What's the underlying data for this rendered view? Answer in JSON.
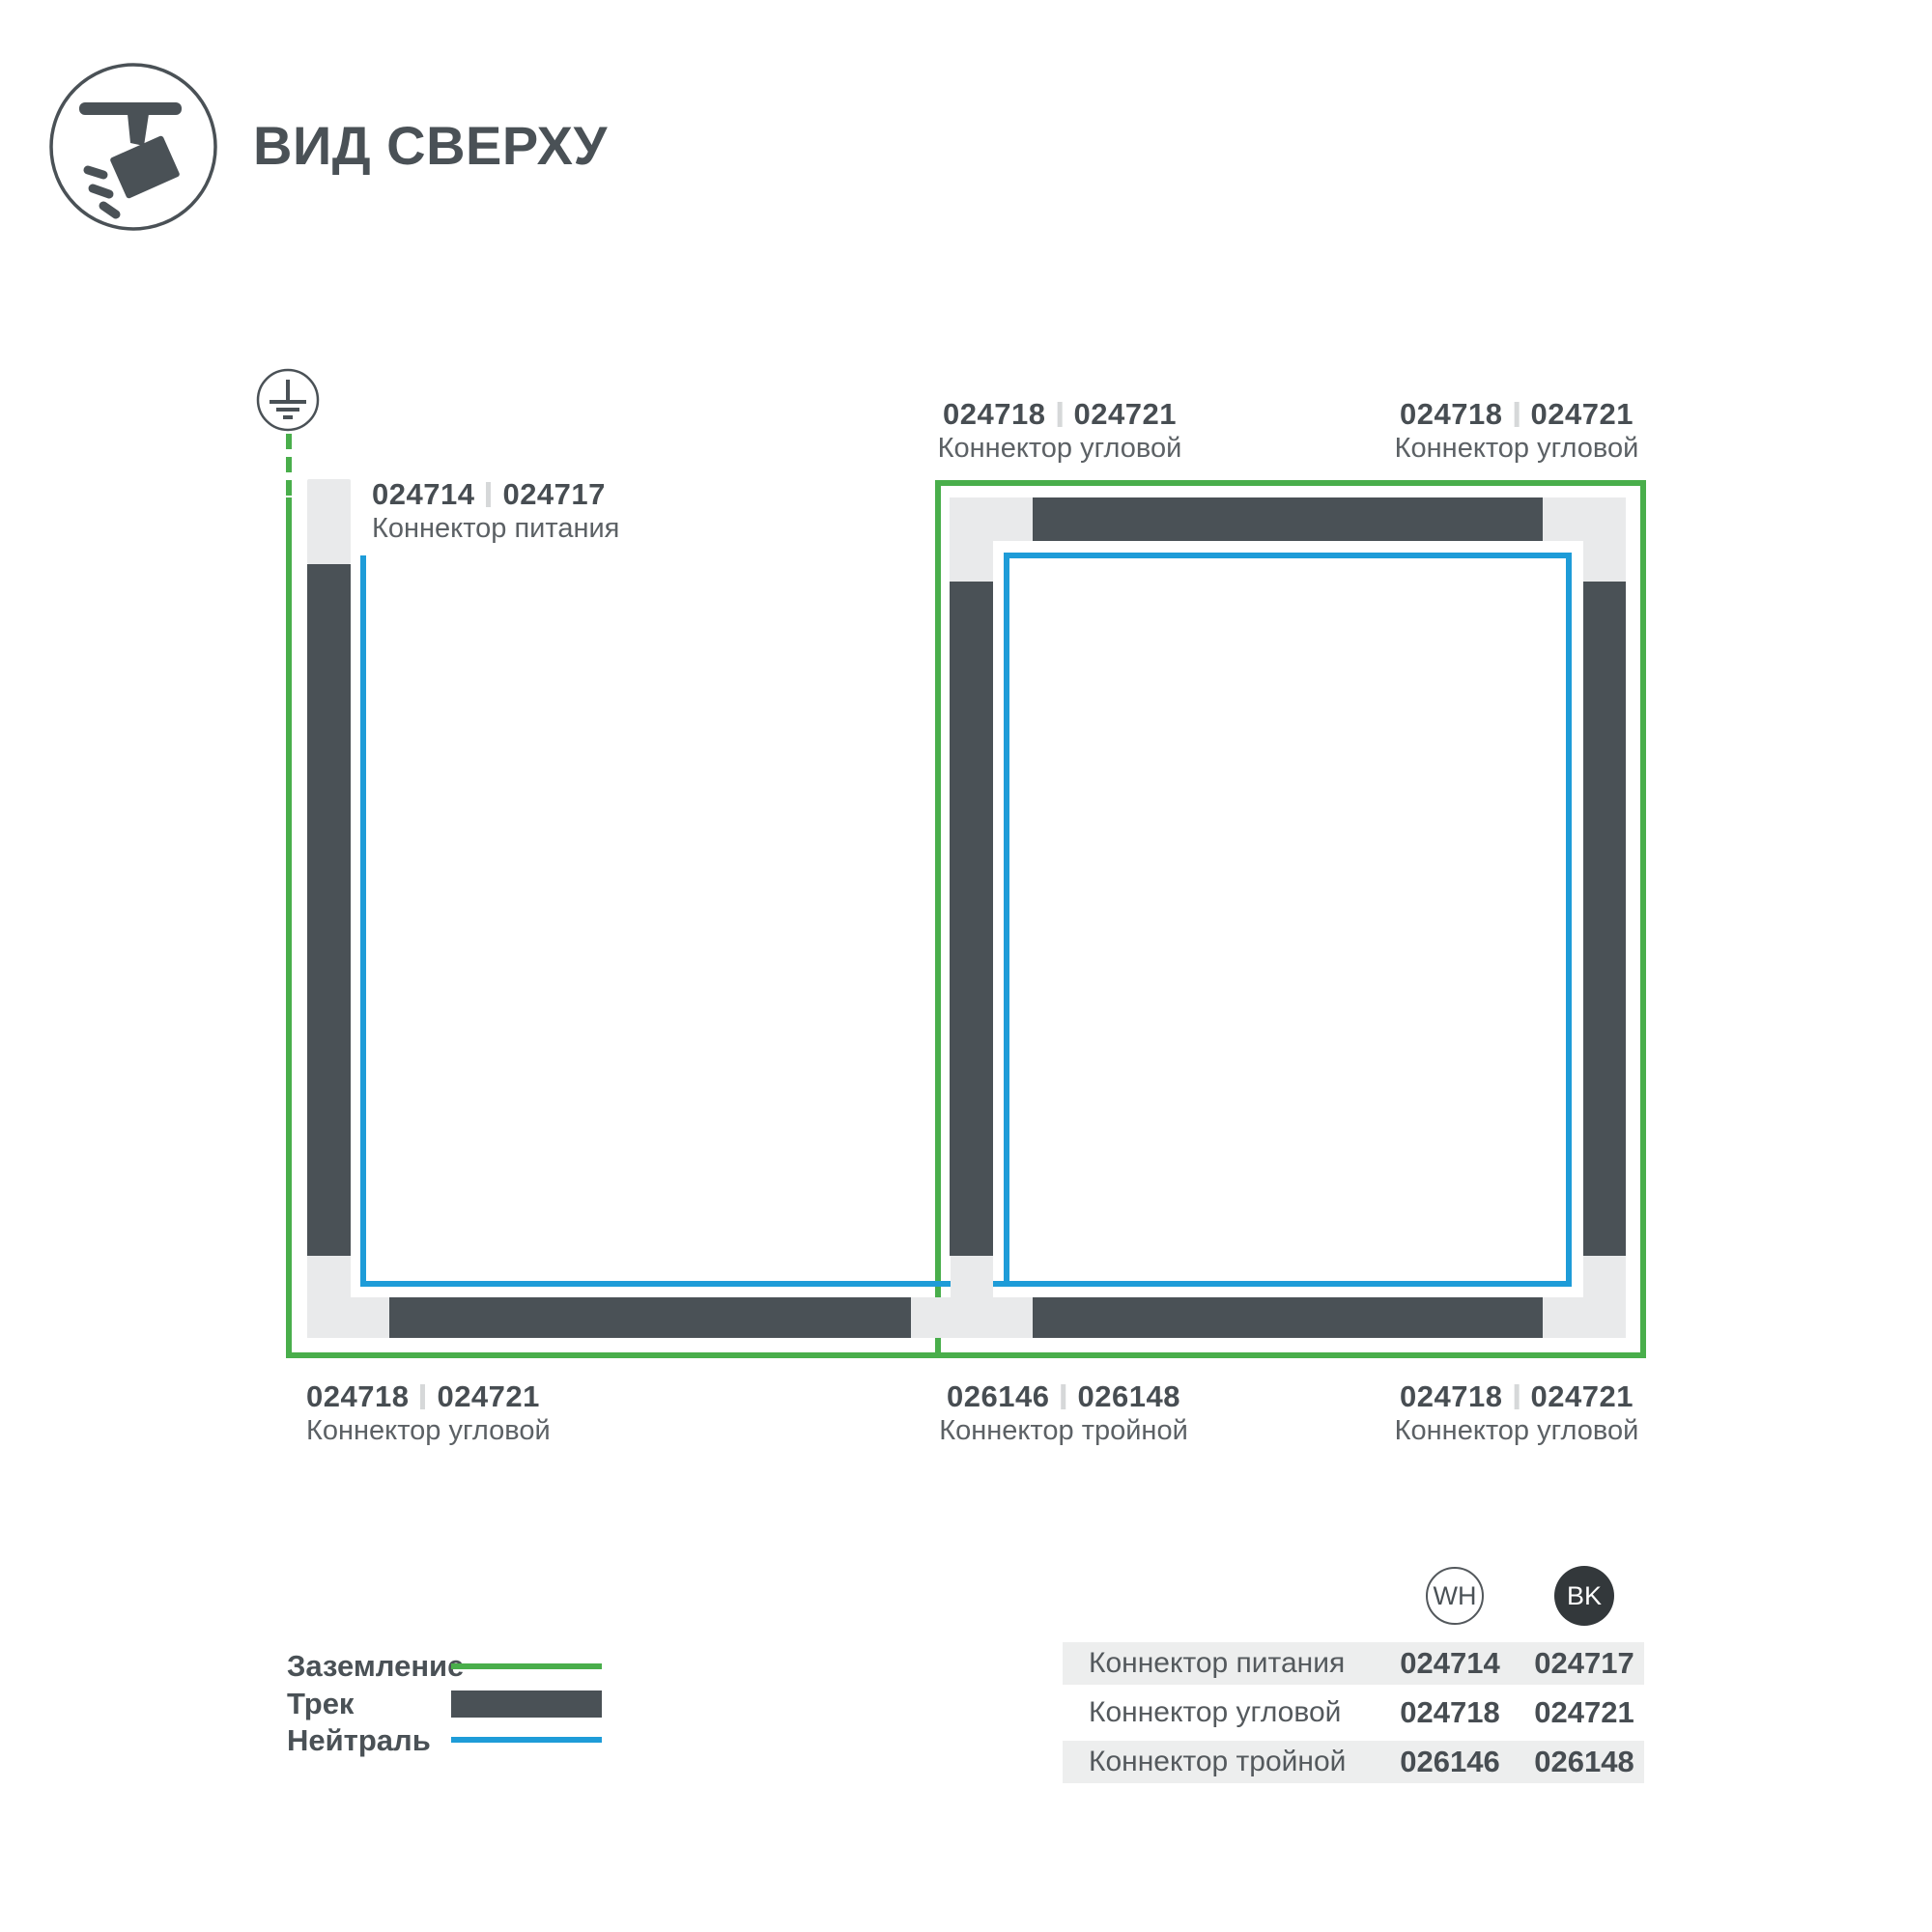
{
  "header": {
    "title": "ВИД СВЕРХУ"
  },
  "diagram": {
    "labels": {
      "power": {
        "wh": "024714",
        "bk": "024717",
        "name": "Коннектор питания"
      },
      "corner_tl": {
        "wh": "024718",
        "bk": "024721",
        "name": "Коннектор угловой"
      },
      "corner_tr": {
        "wh": "024718",
        "bk": "024721",
        "name": "Коннектор угловой"
      },
      "corner_bl": {
        "wh": "024718",
        "bk": "024721",
        "name": "Коннектор угловой"
      },
      "triple": {
        "wh": "026146",
        "bk": "026148",
        "name": "Коннектор тройной"
      },
      "corner_br": {
        "wh": "024718",
        "bk": "024721",
        "name": "Коннектор угловой"
      }
    }
  },
  "legend": {
    "items": [
      {
        "label": "Заземление",
        "swatch": "ground-line",
        "color": "#49AE4B"
      },
      {
        "label": "Трек",
        "swatch": "track-bar",
        "color": "#4A5156"
      },
      {
        "label": "Нейтраль",
        "swatch": "neutral-line",
        "color": "#1E9CD8"
      }
    ]
  },
  "table": {
    "columns": [
      {
        "badge": "WH"
      },
      {
        "badge": "BK"
      }
    ],
    "rows": [
      {
        "name": "Коннектор питания",
        "wh": "024714",
        "bk": "024717"
      },
      {
        "name": "Коннектор угловой",
        "wh": "024718",
        "bk": "024721"
      },
      {
        "name": "Коннектор тройной",
        "wh": "026146",
        "bk": "026148"
      }
    ]
  },
  "colors": {
    "ground_green": "#49AE4B",
    "neutral_blue": "#1E9CD8",
    "track_dark": "#4A5156",
    "connector_gray": "#E9EAEB",
    "table_row_gray": "#EDEEEE"
  }
}
